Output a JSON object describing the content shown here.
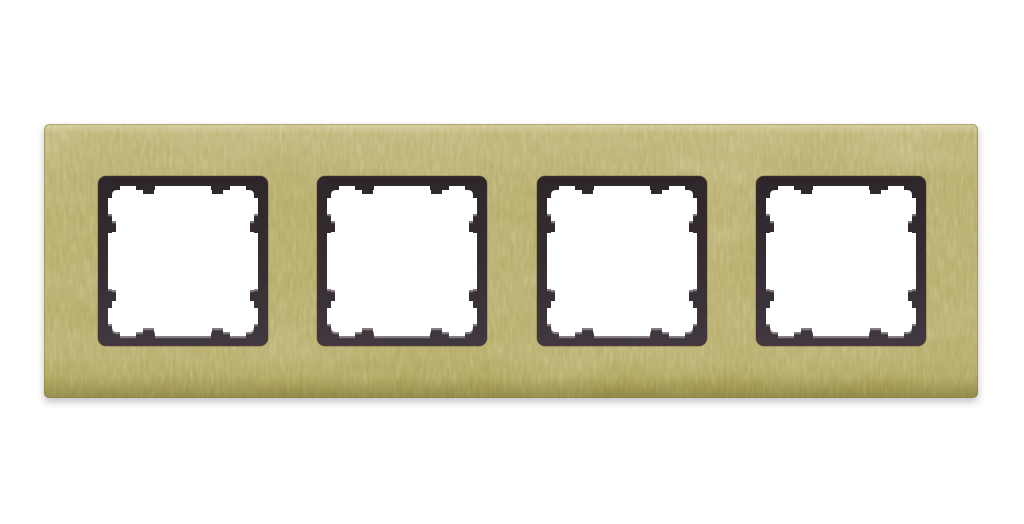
{
  "image": {
    "description": "Product photo of a 4-gang wall switch cover frame in brushed gold brass finish with four square cut-outs, each rimmed by a dark anthracite inner mounting frame with stepped clip notches",
    "openings_count": 4
  },
  "colors": {
    "background": "#ffffff",
    "plate_gold_light": "#bcb274",
    "plate_gold": "#b2a866",
    "plate_gold_dark": "#a2974f",
    "plate_edge": "#8a7f42",
    "frame_dark_top": "#2d262a",
    "frame_dark_mid": "#352d32",
    "frame_dark_bottom": "#413841",
    "frame_warm_edge": "#57392a",
    "inner_highlight": "#8f898d",
    "window_white": "#ffffff"
  }
}
